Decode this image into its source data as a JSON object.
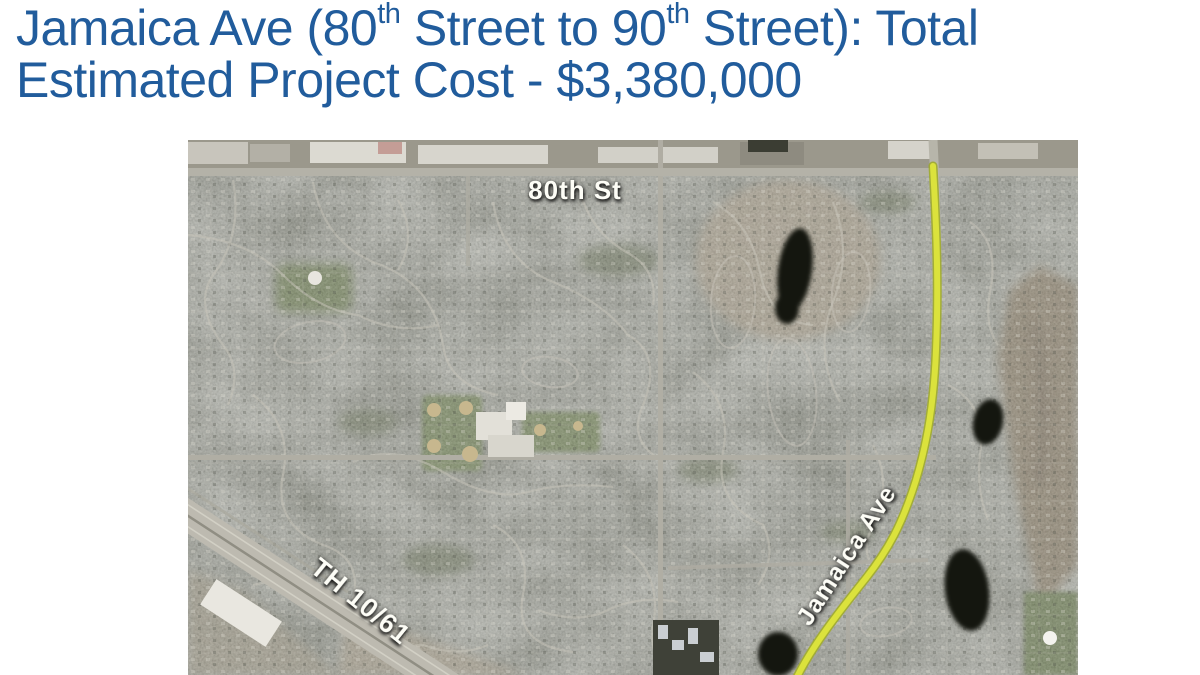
{
  "slide": {
    "title": {
      "line1": {
        "part1": "Jamaica Ave (80",
        "sup1": "th",
        "part2": " Street to 90",
        "sup2": "th",
        "part3": " Street): Total"
      },
      "line2": "Estimated Project Cost - $3,380,000",
      "color": "#215c9c"
    },
    "map": {
      "kind": "aerial-satellite-photo",
      "labels": {
        "cross_street": "80th St",
        "highway": "TH 10/61",
        "project_street": "Jamaica Ave"
      },
      "route_highlight": {
        "label": "Jamaica Ave",
        "color": "#dbe23c"
      }
    }
  }
}
